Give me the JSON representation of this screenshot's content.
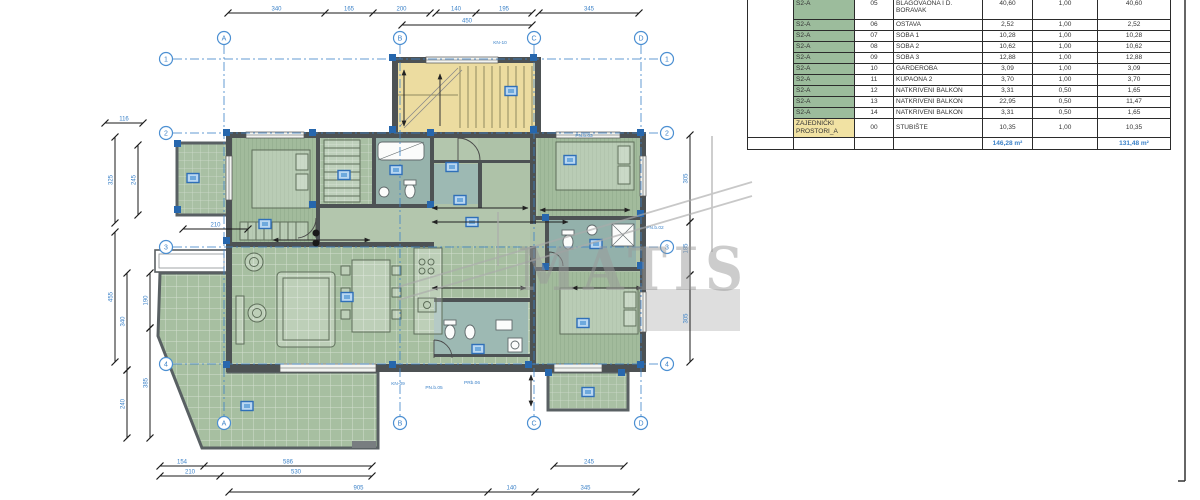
{
  "table": {
    "rows": [
      {
        "unit": "S2-A",
        "no": "05",
        "name": "KUHINJA,\nBLAGOVAONA I D.\nBORAVAK",
        "area": "40,60",
        "coef": "1,00",
        "red": "40,60",
        "h": 32,
        "common": false
      },
      {
        "unit": "S2-A",
        "no": "06",
        "name": "OSTAVA",
        "area": "2,52",
        "coef": "1,00",
        "red": "2,52",
        "h": 11,
        "common": false
      },
      {
        "unit": "S2-A",
        "no": "07",
        "name": "SOBA 1",
        "area": "10,28",
        "coef": "1,00",
        "red": "10,28",
        "h": 11,
        "common": false
      },
      {
        "unit": "S2-A",
        "no": "08",
        "name": "SOBA 2",
        "area": "10,62",
        "coef": "1,00",
        "red": "10,62",
        "h": 11,
        "common": false
      },
      {
        "unit": "S2-A",
        "no": "09",
        "name": "SOBA 3",
        "area": "12,88",
        "coef": "1,00",
        "red": "12,88",
        "h": 11,
        "common": false
      },
      {
        "unit": "S2-A",
        "no": "10",
        "name": "GARDEROBA",
        "area": "3,09",
        "coef": "1,00",
        "red": "3,09",
        "h": 11,
        "common": false
      },
      {
        "unit": "S2-A",
        "no": "11",
        "name": "KUPAONA 2",
        "area": "3,70",
        "coef": "1,00",
        "red": "3,70",
        "h": 11,
        "common": false
      },
      {
        "unit": "S2-A",
        "no": "12",
        "name": "NATKRIVENI BALKON",
        "area": "3,31",
        "coef": "0,50",
        "red": "1,65",
        "h": 11,
        "common": false
      },
      {
        "unit": "S2-A",
        "no": "13",
        "name": "NATKRIVENI BALKON",
        "area": "22,95",
        "coef": "0,50",
        "red": "11,47",
        "h": 11,
        "common": false
      },
      {
        "unit": "S2-A",
        "no": "14",
        "name": "NATKRIVENI BALKON",
        "area": "3,31",
        "coef": "0,50",
        "red": "1,65",
        "h": 11,
        "common": false
      },
      {
        "unit": "ZAJEDNIČKI\nPROSTORI_A",
        "no": "00",
        "name": "STUBIŠTE",
        "area": "10,35",
        "coef": "1,00",
        "red": "10,35",
        "h": 19,
        "common": true
      }
    ],
    "totals": {
      "area": "146,28 m²",
      "red": "131,48 m²"
    },
    "colors": {
      "unit_green": "#9cbc9c",
      "unit_yellow": "#f1e2a3",
      "total_blue": "#3c82c8"
    }
  },
  "plan": {
    "watermark_text": "MATIS",
    "colors": {
      "room_green": "#a7bfa1",
      "stair_yellow": "#ecdca0",
      "bath_teal": "#97b3ac",
      "wall": "#4d5254",
      "blue": "#3c82c8",
      "column_blue": "#2767ad"
    },
    "axes_cols": [
      {
        "id": "A",
        "x": 224
      },
      {
        "id": "B",
        "x": 400
      },
      {
        "id": "C",
        "x": 534
      },
      {
        "id": "D",
        "x": 641
      }
    ],
    "axes_rows": [
      {
        "id": "1",
        "y": 59
      },
      {
        "id": "2",
        "y": 133
      },
      {
        "id": "3",
        "y": 247
      },
      {
        "id": "4",
        "y": 364
      }
    ],
    "marker_pos": {
      "top_y": 38,
      "bottom_y": 423,
      "left_x": 166,
      "right_x": 667
    },
    "dim_chains_h": [
      {
        "y": 13,
        "segs": [
          [
            228,
            325,
            "340"
          ],
          [
            325,
            373,
            "165"
          ],
          [
            373,
            430,
            "200"
          ],
          [
            436,
            476,
            "140"
          ],
          [
            476,
            532,
            "195"
          ],
          [
            539,
            639,
            "345"
          ]
        ]
      },
      {
        "y": 25,
        "segs": [
          [
            402,
            532,
            "450"
          ]
        ]
      },
      {
        "y": 123,
        "segs": [
          [
            105,
            143,
            "116"
          ]
        ]
      },
      {
        "y": 229,
        "segs": [
          [
            183,
            248,
            "210"
          ]
        ]
      },
      {
        "y": 466,
        "segs": [
          [
            160,
            204,
            "154"
          ],
          [
            204,
            372,
            "586"
          ],
          [
            554,
            624,
            "245"
          ]
        ]
      },
      {
        "y": 476,
        "segs": [
          [
            160,
            220,
            "210"
          ],
          [
            220,
            372,
            "530"
          ]
        ]
      },
      {
        "y": 492,
        "segs": [
          [
            229,
            488,
            "905"
          ],
          [
            488,
            535,
            "140"
          ],
          [
            535,
            636,
            "345"
          ]
        ]
      }
    ],
    "dim_chains_v": [
      {
        "x": 115,
        "segs": [
          [
            137,
            223,
            "325"
          ],
          [
            232,
            362,
            "455"
          ]
        ]
      },
      {
        "x": 138,
        "segs": [
          [
            145,
            215,
            "245"
          ]
        ]
      },
      {
        "x": 127,
        "segs": [
          [
            273,
            370,
            "340"
          ],
          [
            370,
            438,
            "240"
          ]
        ]
      },
      {
        "x": 150,
        "segs": [
          [
            273,
            328,
            "190"
          ],
          [
            328,
            438,
            "385"
          ]
        ]
      },
      {
        "x": 690,
        "segs": [
          [
            135,
            222,
            "305"
          ],
          [
            222,
            275,
            "185"
          ],
          [
            275,
            362,
            "305"
          ]
        ]
      }
    ],
    "inner_dims": [
      [
        432,
        208,
        528,
        208
      ],
      [
        432,
        222,
        568,
        222
      ],
      [
        273,
        240,
        370,
        240
      ],
      [
        404,
        70,
        404,
        126
      ],
      [
        540,
        210,
        630,
        210
      ],
      [
        572,
        288,
        642,
        288
      ],
      [
        432,
        288,
        526,
        288
      ],
      [
        531,
        375,
        531,
        406
      ]
    ],
    "annotations": [
      {
        "x": 500,
        "y": 44,
        "t": "KN-10"
      },
      {
        "x": 584,
        "y": 137,
        "t": "PN.b.03"
      },
      {
        "x": 655,
        "y": 229,
        "t": "PN.b.02"
      },
      {
        "x": 434,
        "y": 389,
        "t": "PN.b.05"
      },
      {
        "x": 398,
        "y": 385,
        "t": "KN-09"
      },
      {
        "x": 472,
        "y": 384,
        "t": "PRb.06"
      }
    ],
    "icons": [
      [
        193,
        178
      ],
      [
        265,
        224
      ],
      [
        344,
        175
      ],
      [
        396,
        170
      ],
      [
        452,
        167
      ],
      [
        460,
        200
      ],
      [
        472,
        222
      ],
      [
        347,
        297
      ],
      [
        247,
        406
      ],
      [
        511,
        91
      ],
      [
        570,
        160
      ],
      [
        596,
        244
      ],
      [
        583,
        323
      ],
      [
        588,
        392
      ],
      [
        478,
        349
      ]
    ],
    "columns": [
      [
        392,
        57
      ],
      [
        533,
        57
      ],
      [
        392,
        129
      ],
      [
        533,
        129
      ],
      [
        226,
        132
      ],
      [
        312,
        132
      ],
      [
        226,
        240
      ],
      [
        226,
        364
      ],
      [
        392,
        364
      ],
      [
        528,
        364
      ],
      [
        640,
        132
      ],
      [
        640,
        213
      ],
      [
        640,
        265
      ],
      [
        640,
        364
      ],
      [
        545,
        217
      ],
      [
        545,
        266
      ],
      [
        312,
        204
      ],
      [
        430,
        132
      ],
      [
        430,
        204
      ],
      [
        548,
        372
      ],
      [
        621,
        372
      ],
      [
        177,
        143
      ],
      [
        177,
        209
      ]
    ]
  }
}
